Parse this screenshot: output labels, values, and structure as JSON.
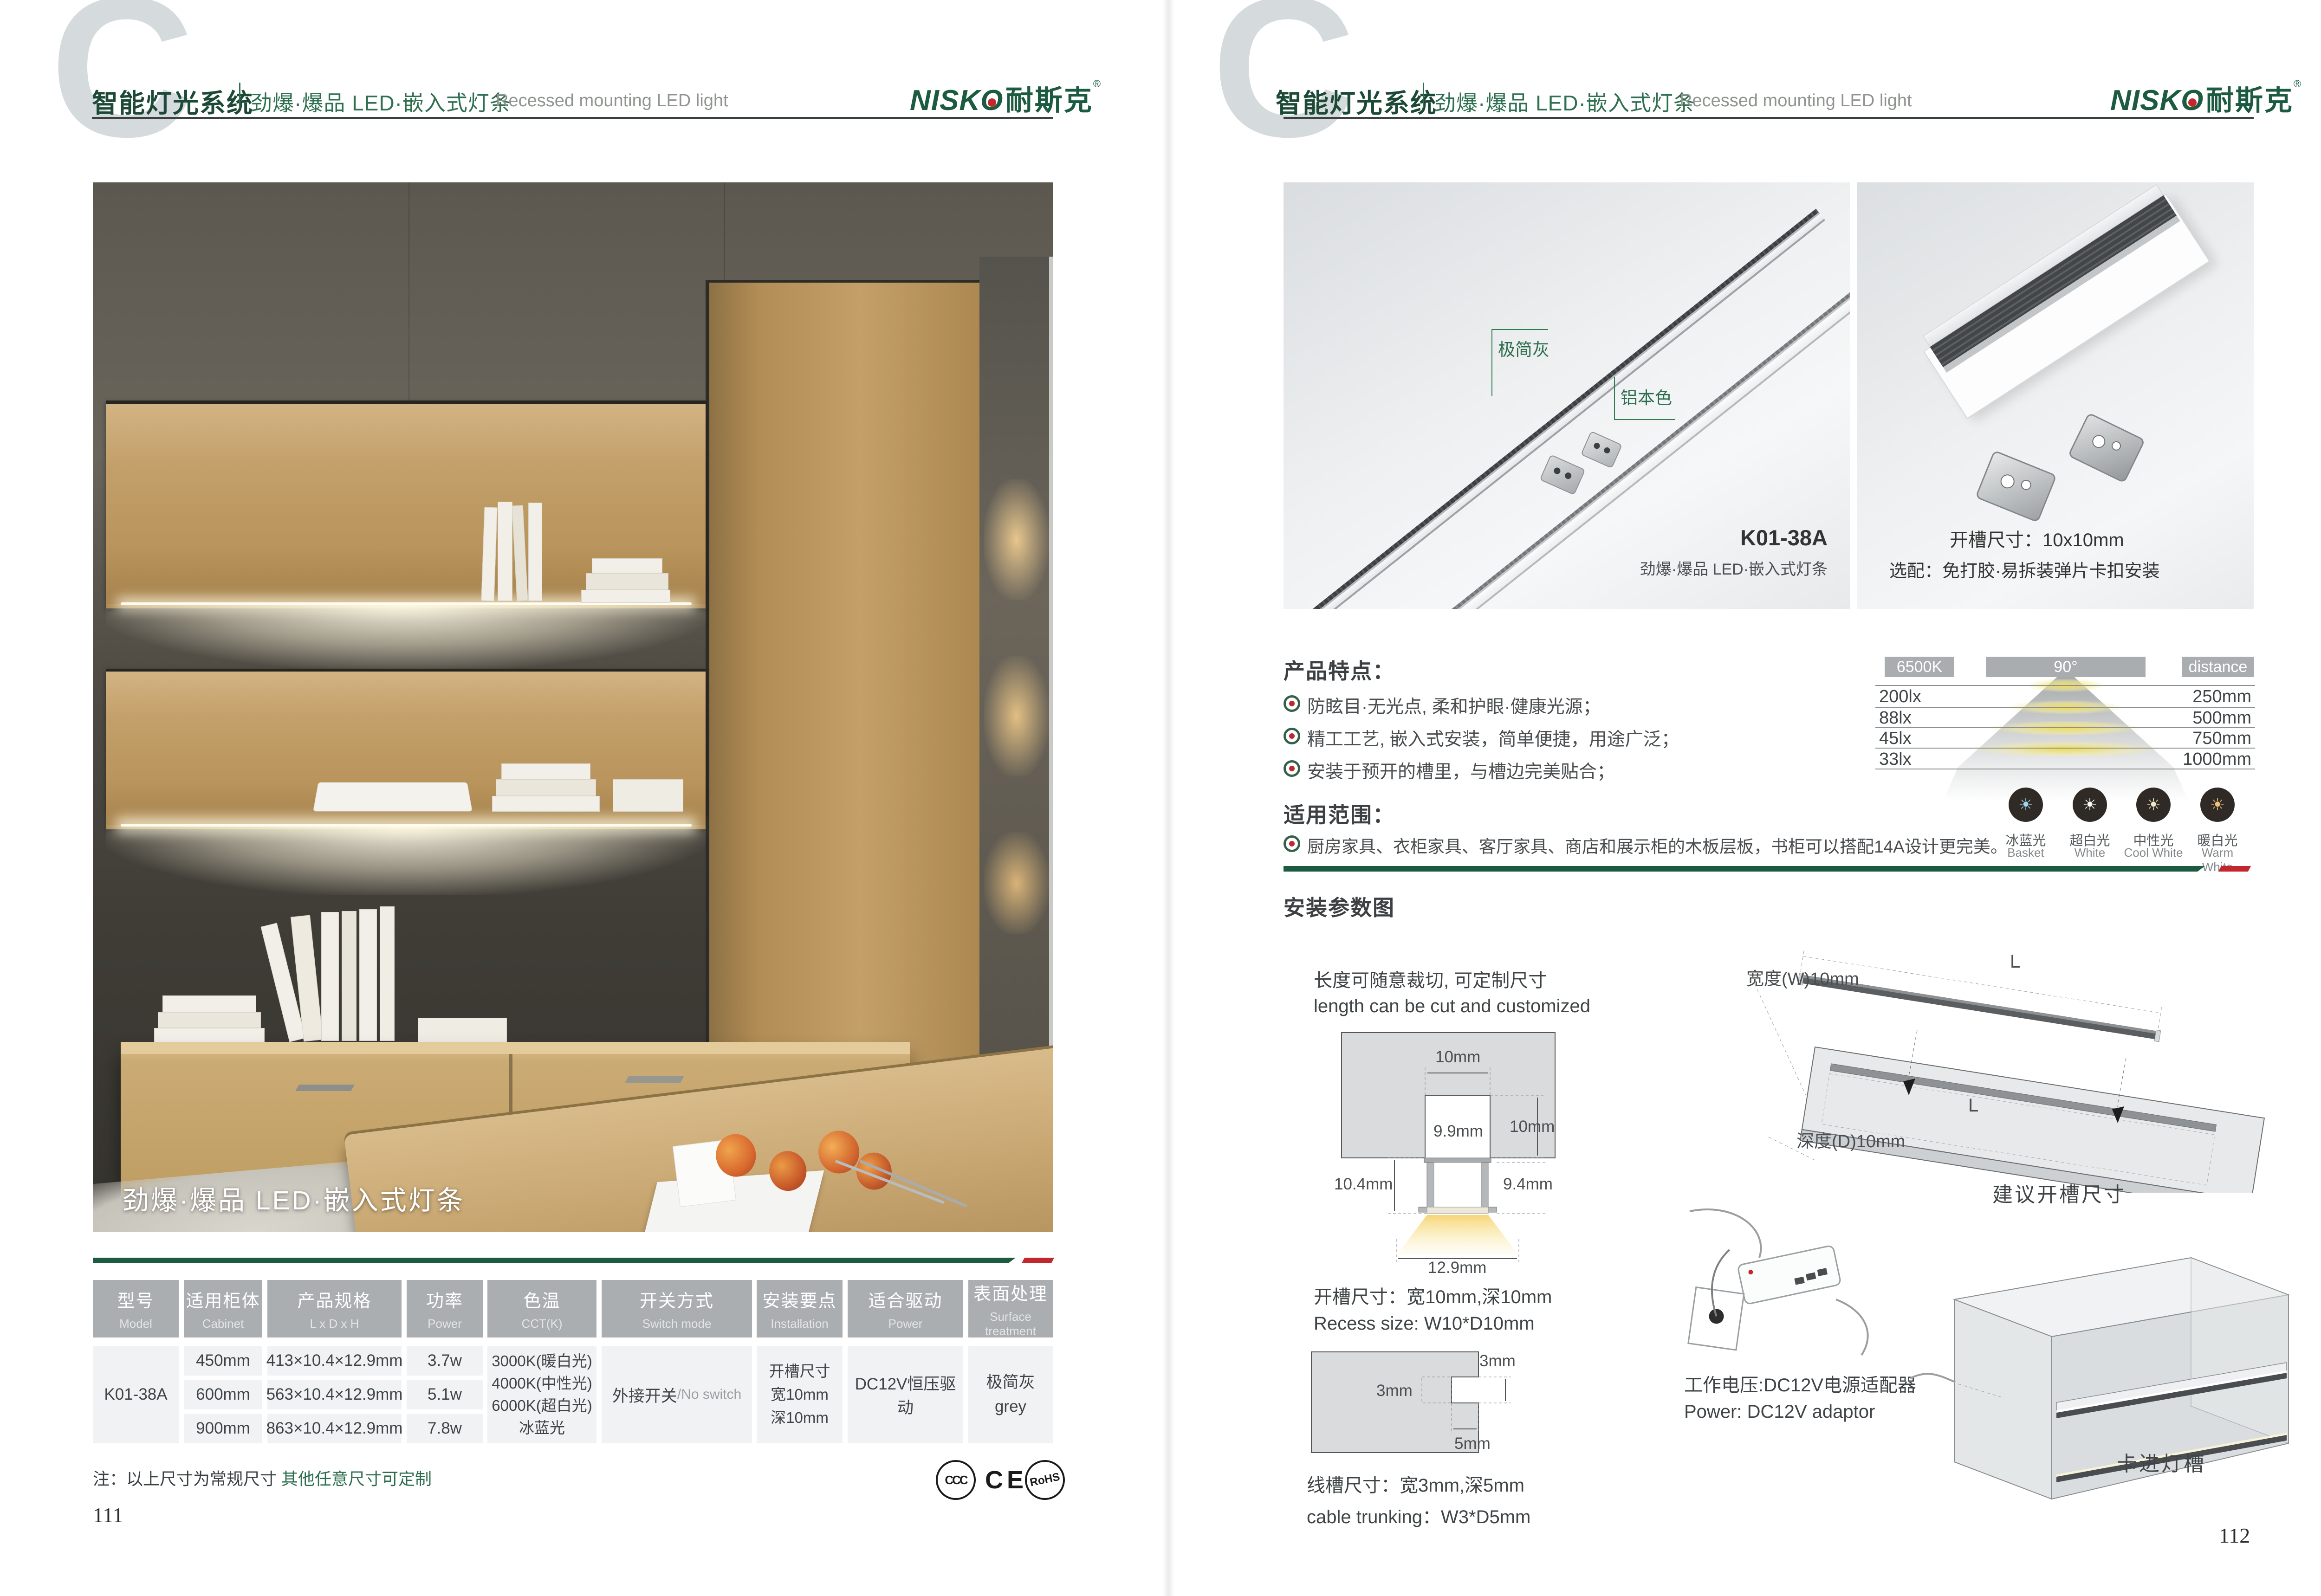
{
  "header": {
    "brand": "智能灯光系统",
    "series": "劲爆·爆品  LED·嵌入式灯条",
    "series_en": "Recessed mounting LED light",
    "logo_en1": "NISK",
    "logo_en2": "O",
    "logo_zh": "耐斯克",
    "logo_reg": "®",
    "watermark": "C"
  },
  "left": {
    "photo_caption": "劲爆·爆品  LED·嵌入式灯条",
    "table": {
      "columns": [
        {
          "zh": "型号",
          "en": "Model"
        },
        {
          "zh": "适用柜体",
          "en": "Cabinet"
        },
        {
          "zh": "产品规格",
          "en": "L x D x H"
        },
        {
          "zh": "功率",
          "en": "Power"
        },
        {
          "zh": "色温",
          "en": "CCT(K)"
        },
        {
          "zh": "开关方式",
          "en": "Switch mode"
        },
        {
          "zh": "安装要点",
          "en": "Installation"
        },
        {
          "zh": "适合驱动",
          "en": "Power"
        },
        {
          "zh": "表面处理",
          "en": "Surface treatment"
        }
      ],
      "model": "K01-38A",
      "rows": [
        {
          "cabinet": "450mm",
          "spec": "413×10.4×12.9mm",
          "power": "3.7w"
        },
        {
          "cabinet": "600mm",
          "spec": "563×10.4×12.9mm",
          "power": "5.1w"
        },
        {
          "cabinet": "900mm",
          "spec": "863×10.4×12.9mm",
          "power": "7.8w"
        }
      ],
      "cct": [
        "3000K(暖白光)",
        "4000K(中性光)",
        "6000K(超白光)",
        "冰蓝光"
      ],
      "switch_zh": "外接开关",
      "switch_en": "/No switch",
      "install": [
        "开槽尺寸",
        "宽10mm",
        "深10mm"
      ],
      "driver": "DC12V恒压驱动",
      "surface_zh": "极简灰",
      "surface_en": "grey"
    },
    "note_black": "注：以上尺寸为常规尺寸 ",
    "note_green": "其他任意尺寸可定制",
    "certs": {
      "ccc": "CCC",
      "ce": "CE",
      "rohs": "RoHS"
    },
    "page_no": "111"
  },
  "right": {
    "photo_a": {
      "label_gray": "极简灰",
      "label_aluminum": "铝本色",
      "model": "K01-38A",
      "caption": "劲爆·爆品  LED·嵌入式灯条"
    },
    "photo_b": {
      "line1": "开槽尺寸：10x10mm",
      "line2": "选配：免打胶·易拆装弹片卡扣安装"
    },
    "features": {
      "title": "产品特点：",
      "items": [
        "防眩目·无光点, 柔和护眼·健康光源；",
        "精工工艺, 嵌入式安装，简单便捷，用途广泛；",
        "安装于预开的槽里，与槽边完美贴合；"
      ]
    },
    "scope": {
      "title": "适用范围：",
      "item": "厨房家具、衣柜家具、客厅家具、商店和展示柜的木板层板，书柜可以搭配14A设计更完美。"
    },
    "photometrics": {
      "temp": "6500K",
      "angle": "90°",
      "distance_label": "distance",
      "rows": [
        {
          "lux": "200lx",
          "dist": "250mm"
        },
        {
          "lux": "88lx",
          "dist": "500mm"
        },
        {
          "lux": "45lx",
          "dist": "750mm"
        },
        {
          "lux": "33lx",
          "dist": "1000mm"
        }
      ],
      "swatches": [
        {
          "zh": "冰蓝光",
          "en": "Basket",
          "color": "#9fd8f0"
        },
        {
          "zh": "超白光",
          "en": "White",
          "color": "#ffffff"
        },
        {
          "zh": "中性光",
          "en": "Cool White",
          "color": "#f2e7c8"
        },
        {
          "zh": "暖白光",
          "en": "Warm White",
          "color": "#f0c27d"
        }
      ],
      "sun_glyph": "☀"
    },
    "install": {
      "title": "安装参数图",
      "cut_zh": "长度可随意裁切, 可定制尺寸",
      "cut_en": "length can be cut and customized",
      "cs_top": "10mm",
      "cs_right": "10mm",
      "cs_inner": "9.9mm",
      "cs_left": "10.4mm",
      "cs_rightwall": "9.4mm",
      "cs_bottom": "12.9mm",
      "recess_zh": "开槽尺寸：宽10mm,深10mm",
      "recess_en": "Recess size: W10*D10mm",
      "trunk_a": "3mm",
      "trunk_b": "3mm",
      "trunk_c": "5mm",
      "trunk_zh": "线槽尺寸：宽3mm,深5mm",
      "trunk_en": "cable trunking：W3*D5mm",
      "power_zh": "工作电压:DC12V电源适配器",
      "power_en": "Power: DC12V adaptor",
      "board_w": "宽度(W)10mm",
      "board_d": "深度(D)10mm",
      "board_l1": "L",
      "board_l2": "L",
      "board_caption": "建议开槽尺寸",
      "cabinet_label": "卡进灯槽"
    },
    "page_no": "112"
  }
}
